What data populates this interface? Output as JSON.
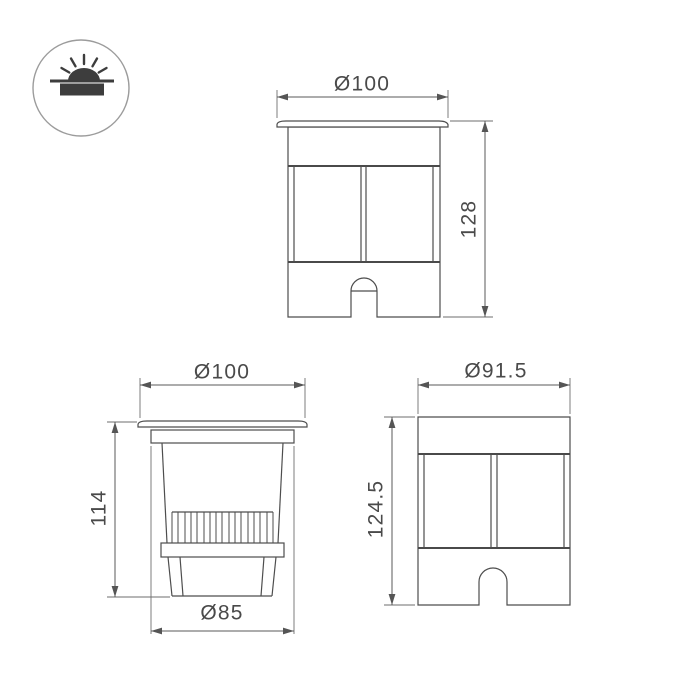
{
  "page": {
    "background": "#ffffff",
    "type": "technical-dimension-drawing"
  },
  "icon": {
    "meaning": "recessed-inground-luminaire-symbol"
  },
  "views": {
    "front": {
      "diameter": "Ø100",
      "height": "128"
    },
    "section": {
      "diameter": "Ø100",
      "height": "114",
      "base_diameter": "Ø85"
    },
    "rear": {
      "diameter": "Ø91.5",
      "height": "124.5"
    }
  },
  "colors": {
    "outline": "#4d4d4d",
    "dimension_lines": "#5a5a5a",
    "label_text": "#4a4a4a",
    "icon": "#3d3d3d",
    "icon_ring": "#9c9c9c"
  }
}
